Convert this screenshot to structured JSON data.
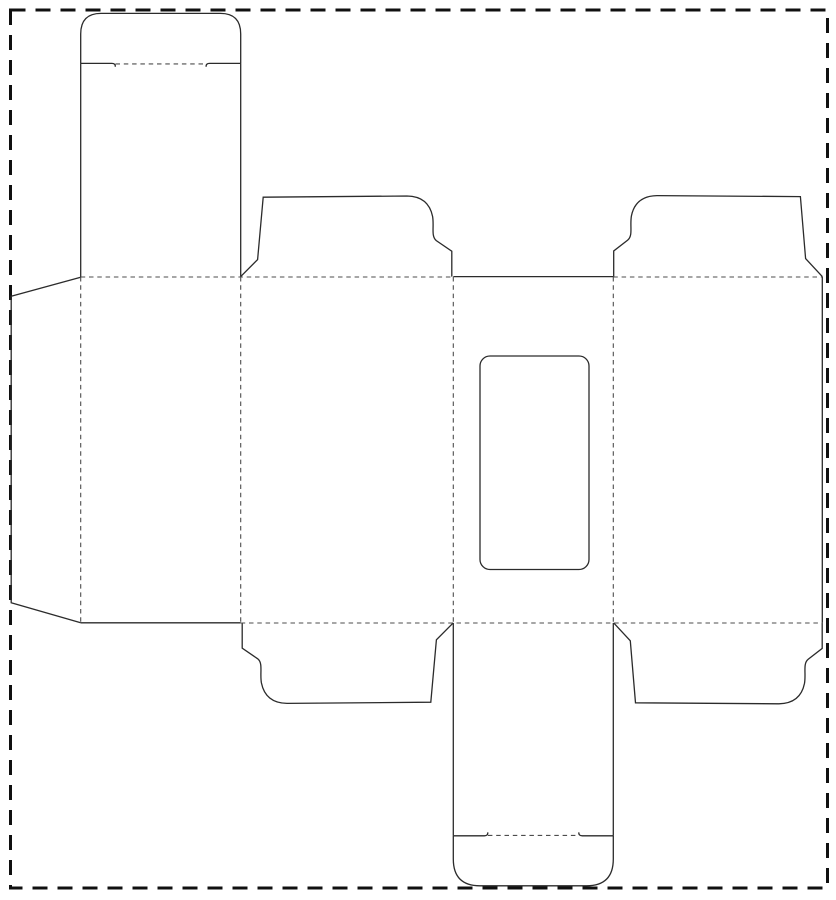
{
  "meta": {
    "title": "Folding carton box die-cut template (dieline) with window cutout, tuck-top cap, dust flaps and glue flap",
    "kind": "packaging-dieline-diagram"
  },
  "canvas": {
    "width": 836,
    "height": 900,
    "background": "#ffffff"
  },
  "styles": {
    "cut": {
      "color": "#2b2b2b",
      "width": 1.3,
      "dash": ""
    },
    "fold": {
      "color": "#4d4d4d",
      "width": 1.1,
      "dash": "4.5 3.8"
    },
    "border": {
      "color": "#101010",
      "width": 3,
      "dash": "15 10"
    }
  },
  "shapes": [
    {
      "name": "page-cut-border",
      "type": "rect",
      "style": "border",
      "x": 10.5,
      "y": 10,
      "w": 817,
      "h": 878,
      "rx": 0
    },
    {
      "name": "top-tuck-cap-outline",
      "type": "path",
      "style": "cut",
      "d": "M 80.7 63.4 L 80.7 34 Q 80.7 13.4 101 13.4 L 220.4 13.4 Q 240.7 13.4 240.7 34 L 240.7 63.4"
    },
    {
      "name": "top-tuck-lock-slit-left",
      "type": "path",
      "style": "cut",
      "d": "M 80.7 63.4 L 111.8 63.4 C 114.3 63.4 115.6 64.6 115.2 66.8"
    },
    {
      "name": "top-tuck-lock-slit-right",
      "type": "path",
      "style": "cut",
      "d": "M 240.7 63.4 L 209.6 63.4 C 207.1 63.4 205.8 64.6 206.2 66.8"
    },
    {
      "name": "top-tuck-fold",
      "type": "path",
      "style": "fold",
      "d": "M 115.5 63.9 L 206 63.9"
    },
    {
      "name": "top-lid-left-edge",
      "type": "path",
      "style": "cut",
      "d": "M 80.7 63.4 L 80.7 277"
    },
    {
      "name": "top-lid-right-edge",
      "type": "path",
      "style": "cut",
      "d": "M 240.7 63.4 L 240.7 277"
    },
    {
      "name": "top-dust-flap-left",
      "type": "path",
      "style": "cut",
      "d": "M 240.7 276.6 L 257.6 259.6 L 263.2 197.2 L 407 196 Q 428.5 196.3 432.6 216.5 C 434.3 226.5 430.8 236.2 436.3 240.6 L 451.8 251.2 L 451.8 276.6"
    },
    {
      "name": "top-dust-flap-right",
      "type": "path",
      "style": "cut",
      "d": "M 822.3 276.6 L 805.6 258.6 L 800.4 196.6 L 657 195.6 Q 635.5 195.9 631.4 216 C 629.7 226 633.2 235.7 627.7 240.1 L 613.7 251 L 613.7 276.6"
    },
    {
      "name": "bottom-dust-flap-left",
      "type": "path",
      "style": "cut",
      "transform": "rotate(180 347 449.7)",
      "d": "M 240.7 276.6 L 257.6 259.6 L 263.2 197.2 L 407 196 Q 428.5 196.3 432.6 216.5 C 434.3 226.5 430.8 236.2 436.3 240.6 L 451.8 251.2 L 451.8 276.6"
    },
    {
      "name": "bottom-dust-flap-right",
      "type": "path",
      "style": "cut",
      "transform": "rotate(180 717.95 449.7)",
      "d": "M 822.3 276.6 L 805.6 258.6 L 800.4 196.6 L 657 195.6 Q 635.5 195.9 631.4 216 C 629.7 226 633.2 235.7 627.7 240.1 L 613.7 251 L 613.7 276.6"
    },
    {
      "name": "front-panel-top-cut",
      "type": "path",
      "style": "cut",
      "d": "M 453.3 276.6 L 613.3 276.6"
    },
    {
      "name": "back-panel-bottom-cut",
      "type": "path",
      "style": "cut",
      "d": "M 80.7 622.8 L 240.7 622.8"
    },
    {
      "name": "band-right-edge-cut",
      "type": "path",
      "style": "cut",
      "d": "M 822.3 276.6 L 822.3 622.8"
    },
    {
      "name": "glue-flap-outline",
      "type": "path",
      "style": "cut",
      "d": "M 80.7 277.2 L 11.2 296.2 L 11.2 602.8 L 80.7 622.8"
    },
    {
      "name": "window-cutout",
      "type": "rect",
      "style": "cut",
      "x": 480,
      "y": 356,
      "w": 109,
      "h": 213.5,
      "rx": 10
    },
    {
      "name": "band-top-fold-left",
      "type": "path",
      "style": "fold",
      "d": "M 80.7 277 L 453.3 277"
    },
    {
      "name": "band-top-fold-right",
      "type": "path",
      "style": "fold",
      "d": "M 613.3 277 L 822.3 277"
    },
    {
      "name": "band-bottom-fold",
      "type": "path",
      "style": "fold",
      "d": "M 240.7 623 L 822.3 623"
    },
    {
      "name": "glue-flap-fold",
      "type": "path",
      "style": "fold",
      "d": "M 80.7 277 L 80.7 622.8"
    },
    {
      "name": "back-side-panel-fold",
      "type": "path",
      "style": "fold",
      "d": "M 240.7 277 L 240.7 622.8"
    },
    {
      "name": "side-front-panel-fold",
      "type": "path",
      "style": "fold",
      "d": "M 453.3 277 L 453.3 623"
    },
    {
      "name": "front-side-panel-fold",
      "type": "path",
      "style": "fold",
      "d": "M 613.3 277 L 613.3 623"
    },
    {
      "name": "bottom-lid-left-edge",
      "type": "path",
      "style": "cut",
      "d": "M 453.3 623 L 453.3 835.8"
    },
    {
      "name": "bottom-lid-right-edge",
      "type": "path",
      "style": "cut",
      "d": "M 613.3 623 L 613.3 835.8"
    },
    {
      "name": "bottom-tuck-cap-outline",
      "type": "path",
      "style": "cut",
      "d": "M 453.3 835.8 L 453.3 859 Q 453.3 885.8 480 885.8 L 586.6 885.8 Q 613.3 885.8 613.3 859 L 613.3 835.8"
    },
    {
      "name": "bottom-tuck-lock-slit-left",
      "type": "path",
      "style": "cut",
      "d": "M 453.3 835.8 L 484.3 835.8 C 486.8 835.8 488.1 834.6 487.7 832.4"
    },
    {
      "name": "bottom-tuck-lock-slit-right",
      "type": "path",
      "style": "cut",
      "d": "M 613.3 835.8 L 582.3 835.8 C 579.8 835.8 578.5 834.6 578.9 832.4"
    },
    {
      "name": "bottom-tuck-fold",
      "type": "path",
      "style": "fold",
      "d": "M 487.9 835.4 L 578.7 835.4"
    }
  ]
}
